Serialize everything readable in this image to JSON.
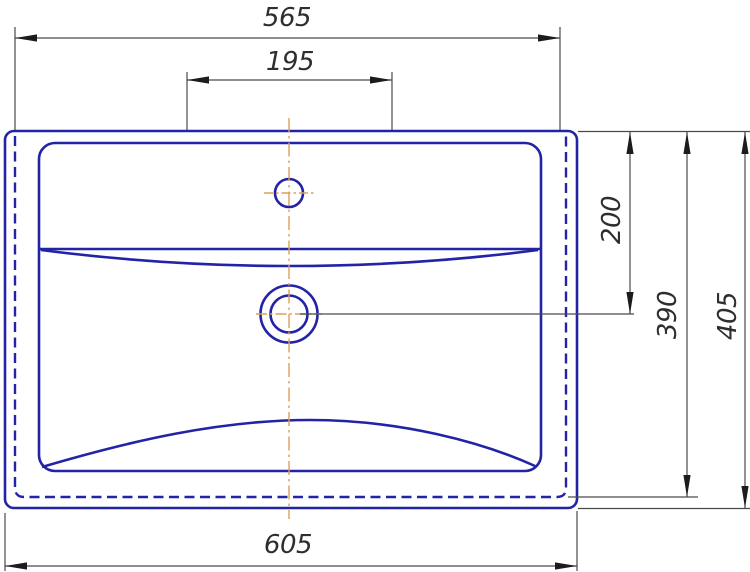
{
  "drawing": {
    "title": "Washbasin top-view technical drawing",
    "dimensions": {
      "top_width": "565",
      "faucet_ledge_width": "195",
      "bottom_width": "605",
      "drain_offset_depth": "200",
      "body_depth": "390",
      "overall_depth": "405"
    },
    "colors": {
      "outline": "#2323a6",
      "dimline": "#4a4a4a",
      "arrow": "#1c1c1c",
      "dimtext": "#2e2e2e",
      "centerline": "#dba05a",
      "bg": "#ffffff"
    }
  }
}
